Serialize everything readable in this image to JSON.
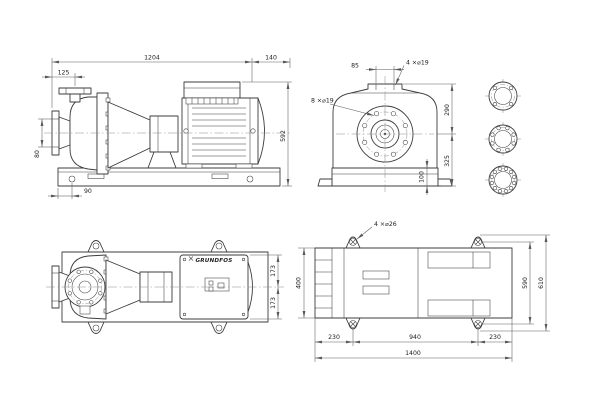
{
  "meta": {
    "title": "pump dimensional drawing",
    "colors": {
      "ink": "#3c3c3c",
      "dim": "#5a5a5a",
      "cl": "#8c8c8c",
      "bg": "#ffffff"
    }
  },
  "side_view": {
    "dims": {
      "overall_length": "1204",
      "rear_overhang": "140",
      "flange_offset": "125",
      "suction_flange_span": "80",
      "overall_height": "592",
      "anchor_offset": "90"
    }
  },
  "end_view": {
    "labels": {
      "discharge_holes": "4 ×⌀19",
      "suction_holes": "8 ×⌀19"
    },
    "dims": {
      "discharge_bolt_spacing": "85",
      "center_to_top": "290",
      "center_to_base": "325",
      "baseplate_height": "100"
    }
  },
  "top_view": {
    "logo": "GRUNDFOS",
    "dims": {
      "center_to_front": "173",
      "center_to_rear": "173"
    }
  },
  "baseplate_view": {
    "labels": {
      "anchor_holes": "4 ×⌀26"
    },
    "dims": {
      "plate_width": "400",
      "anchor_left": "230",
      "anchor_span": "940",
      "anchor_right": "230",
      "plate_length": "1400",
      "anchor_width": "590",
      "ear_width": "610"
    }
  }
}
